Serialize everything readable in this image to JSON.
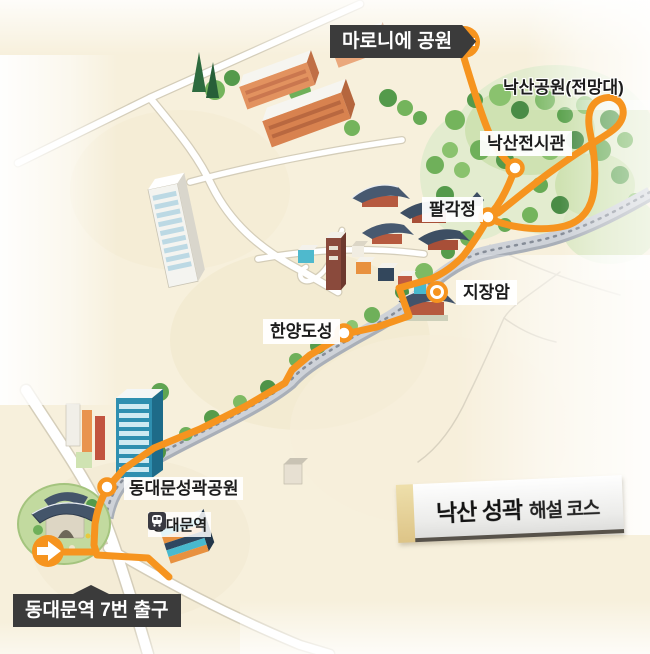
{
  "title_ribbon": {
    "part1": "낙산 성곽",
    "part2": "해설 코스"
  },
  "labels": {
    "maronie_park": "마로니에 공원",
    "naksan_park": "낙산공원(전망대)",
    "naksan_exhibition": "낙산전시관",
    "palgakjeong": "팔각정",
    "jijangam": "지장암",
    "hanyang_fortress": "한양도성",
    "dongdaemun_fortress_park": "동대문성곽공원",
    "dongdaemun_station": "동대문역",
    "exit7": "동대문역 7번 출구"
  },
  "route": {
    "name": "낙산 성곽 해설 코스",
    "color": "#f6941f",
    "start": "동대문역 7번 출구",
    "end": "마로니에 공원",
    "stops_in_order": [
      "동대문역 7번 출구",
      "동대문성곽공원",
      "한양도성",
      "지장암",
      "팔각정",
      "낙산전시관",
      "낙산공원(전망대)",
      "마로니에 공원"
    ]
  },
  "icons": {
    "station_icon": "subway-station-icon",
    "start_arrow": "arrow-right",
    "end_arrow": "arrow-left"
  },
  "colors": {
    "route_orange": "#f6941f",
    "label_dark": "#3b3b3b",
    "map_cream": "#f7f0dc",
    "wall_gray": "#ced2d8",
    "park_green": "#cfe2b2"
  }
}
